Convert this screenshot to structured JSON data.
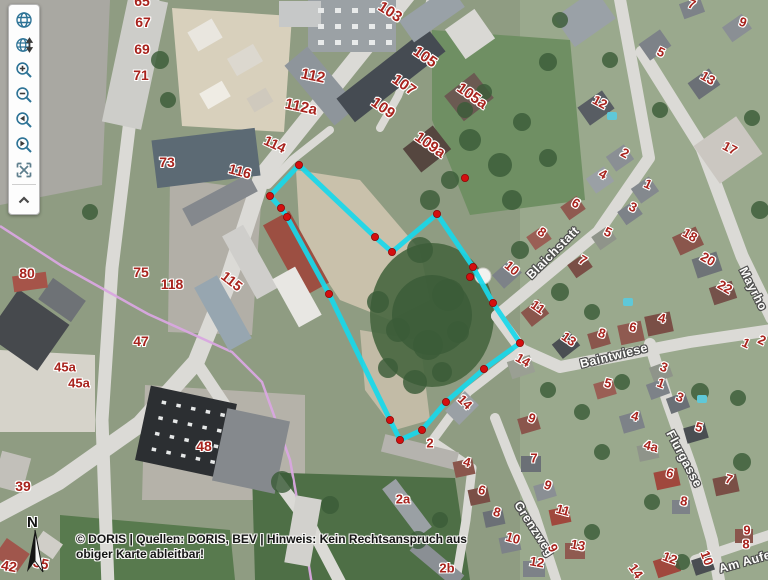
{
  "map": {
    "copyright_line1": "© DORIS | Quellen: DORIS, BEV | Hinweis: Kein Rechtsanspruch aus",
    "copyright_line2": "obiger Karte ableitbar!",
    "north_label": "N",
    "colors": {
      "parcel_stroke": "#18d8ea",
      "vertex_dot": "#d40f0f",
      "house_number": "#a8231d",
      "street_text": "#fdfdfb",
      "boundary_line": "#d9a7e0"
    },
    "house_numbers": [
      {
        "t": "65",
        "x": 142,
        "y": 1,
        "r": 0,
        "s": 14
      },
      {
        "t": "67",
        "x": 143,
        "y": 22,
        "r": 0,
        "s": 14
      },
      {
        "t": "69",
        "x": 142,
        "y": 49,
        "r": 0,
        "s": 14
      },
      {
        "t": "71",
        "x": 141,
        "y": 75,
        "r": 0,
        "s": 14
      },
      {
        "t": "73",
        "x": 167,
        "y": 162,
        "r": 0,
        "s": 14
      },
      {
        "t": "80",
        "x": 27,
        "y": 273,
        "r": 0,
        "s": 14
      },
      {
        "t": "75",
        "x": 141,
        "y": 272,
        "r": 0,
        "s": 14
      },
      {
        "t": "118",
        "x": 172,
        "y": 284,
        "r": 0,
        "s": 14
      },
      {
        "t": "115",
        "x": 232,
        "y": 281,
        "r": 38,
        "s": 14
      },
      {
        "t": "114",
        "x": 275,
        "y": 144,
        "r": 25,
        "s": 14
      },
      {
        "t": "116",
        "x": 240,
        "y": 171,
        "r": 15,
        "s": 14
      },
      {
        "t": "47",
        "x": 141,
        "y": 341,
        "r": 0,
        "s": 14
      },
      {
        "t": "45a",
        "x": 65,
        "y": 367,
        "r": 0,
        "s": 13
      },
      {
        "t": "45a",
        "x": 79,
        "y": 383,
        "r": 0,
        "s": 13
      },
      {
        "t": "39",
        "x": 23,
        "y": 486,
        "r": 0,
        "s": 14
      },
      {
        "t": "48",
        "x": 204,
        "y": 446,
        "r": 0,
        "s": 14
      },
      {
        "t": "42",
        "x": 9,
        "y": 566,
        "r": 10,
        "s": 14
      },
      {
        "t": "35",
        "x": 41,
        "y": 563,
        "r": 12,
        "s": 14
      },
      {
        "t": "112",
        "x": 313,
        "y": 76,
        "r": 12,
        "s": 15
      },
      {
        "t": "112a",
        "x": 301,
        "y": 107,
        "r": 12,
        "s": 15
      },
      {
        "t": "103",
        "x": 390,
        "y": 12,
        "r": 33,
        "s": 15
      },
      {
        "t": "105",
        "x": 425,
        "y": 57,
        "r": 35,
        "s": 15
      },
      {
        "t": "107",
        "x": 404,
        "y": 85,
        "r": 35,
        "s": 15
      },
      {
        "t": "109",
        "x": 383,
        "y": 108,
        "r": 35,
        "s": 15
      },
      {
        "t": "105a",
        "x": 472,
        "y": 96,
        "r": 35,
        "s": 15
      },
      {
        "t": "109a",
        "x": 430,
        "y": 145,
        "r": 35,
        "s": 15
      },
      {
        "t": "7",
        "x": 692,
        "y": 4,
        "r": 20,
        "s": 13
      },
      {
        "t": "9",
        "x": 743,
        "y": 22,
        "r": 20,
        "s": 13
      },
      {
        "t": "5",
        "x": 661,
        "y": 52,
        "r": 25,
        "s": 13
      },
      {
        "t": "13",
        "x": 708,
        "y": 78,
        "r": 30,
        "s": 13
      },
      {
        "t": "12",
        "x": 600,
        "y": 102,
        "r": 28,
        "s": 13
      },
      {
        "t": "17",
        "x": 730,
        "y": 148,
        "r": 28,
        "s": 13
      },
      {
        "t": "2",
        "x": 625,
        "y": 153,
        "r": 28,
        "s": 13
      },
      {
        "t": "4",
        "x": 603,
        "y": 174,
        "r": 28,
        "s": 13
      },
      {
        "t": "1",
        "x": 648,
        "y": 184,
        "r": 25,
        "s": 13
      },
      {
        "t": "6",
        "x": 576,
        "y": 203,
        "r": 30,
        "s": 13
      },
      {
        "t": "3",
        "x": 633,
        "y": 207,
        "r": 25,
        "s": 13
      },
      {
        "t": "8",
        "x": 542,
        "y": 232,
        "r": 35,
        "s": 13
      },
      {
        "t": "5",
        "x": 608,
        "y": 232,
        "r": 25,
        "s": 13
      },
      {
        "t": "7",
        "x": 583,
        "y": 260,
        "r": 30,
        "s": 13
      },
      {
        "t": "18",
        "x": 690,
        "y": 235,
        "r": 30,
        "s": 13
      },
      {
        "t": "20",
        "x": 708,
        "y": 259,
        "r": 30,
        "s": 13
      },
      {
        "t": "22",
        "x": 725,
        "y": 287,
        "r": 30,
        "s": 13
      },
      {
        "t": "10",
        "x": 512,
        "y": 268,
        "r": 40,
        "s": 13
      },
      {
        "t": "11",
        "x": 538,
        "y": 307,
        "r": 35,
        "s": 13
      },
      {
        "t": "1",
        "x": 746,
        "y": 343,
        "r": 25,
        "s": 13
      },
      {
        "t": "2",
        "x": 762,
        "y": 340,
        "r": 25,
        "s": 13
      },
      {
        "t": "13",
        "x": 569,
        "y": 339,
        "r": 35,
        "s": 13
      },
      {
        "t": "14",
        "x": 523,
        "y": 360,
        "r": 30,
        "s": 13
      },
      {
        "t": "8",
        "x": 602,
        "y": 333,
        "r": 16,
        "s": 13
      },
      {
        "t": "6",
        "x": 633,
        "y": 327,
        "r": 12,
        "s": 13
      },
      {
        "t": "4",
        "x": 662,
        "y": 318,
        "r": 12,
        "s": 13
      },
      {
        "t": "3",
        "x": 664,
        "y": 367,
        "r": 20,
        "s": 13
      },
      {
        "t": "1",
        "x": 661,
        "y": 383,
        "r": 20,
        "s": 13
      },
      {
        "t": "3",
        "x": 680,
        "y": 397,
        "r": 20,
        "s": 13
      },
      {
        "t": "5",
        "x": 608,
        "y": 383,
        "r": 15,
        "s": 13
      },
      {
        "t": "14",
        "x": 465,
        "y": 402,
        "r": 45,
        "s": 13
      },
      {
        "t": "9",
        "x": 532,
        "y": 418,
        "r": 20,
        "s": 13
      },
      {
        "t": "4",
        "x": 635,
        "y": 416,
        "r": 15,
        "s": 13
      },
      {
        "t": "5",
        "x": 699,
        "y": 427,
        "r": 15,
        "s": 13
      },
      {
        "t": "7",
        "x": 534,
        "y": 458,
        "r": 0,
        "s": 13
      },
      {
        "t": "7",
        "x": 729,
        "y": 479,
        "r": 15,
        "s": 13
      },
      {
        "t": "4a",
        "x": 651,
        "y": 446,
        "r": 15,
        "s": 13
      },
      {
        "t": "6",
        "x": 670,
        "y": 473,
        "r": 15,
        "s": 13
      },
      {
        "t": "9",
        "x": 548,
        "y": 485,
        "r": 20,
        "s": 13
      },
      {
        "t": "8",
        "x": 684,
        "y": 501,
        "r": 10,
        "s": 13
      },
      {
        "t": "8",
        "x": 497,
        "y": 512,
        "r": 15,
        "s": 13
      },
      {
        "t": "11",
        "x": 563,
        "y": 510,
        "r": 15,
        "s": 13
      },
      {
        "t": "9",
        "x": 747,
        "y": 530,
        "r": 0,
        "s": 13
      },
      {
        "t": "8",
        "x": 746,
        "y": 544,
        "r": 0,
        "s": 13
      },
      {
        "t": "10",
        "x": 513,
        "y": 538,
        "r": 15,
        "s": 13
      },
      {
        "t": "13",
        "x": 578,
        "y": 545,
        "r": 10,
        "s": 13
      },
      {
        "t": "12",
        "x": 537,
        "y": 562,
        "r": 10,
        "s": 13
      },
      {
        "t": "9",
        "x": 553,
        "y": 548,
        "r": 65,
        "s": 13
      },
      {
        "t": "14",
        "x": 636,
        "y": 571,
        "r": 55,
        "s": 13
      },
      {
        "t": "12",
        "x": 670,
        "y": 558,
        "r": 20,
        "s": 13
      },
      {
        "t": "10",
        "x": 707,
        "y": 558,
        "r": 70,
        "s": 13
      },
      {
        "t": "2",
        "x": 430,
        "y": 443,
        "r": 0,
        "s": 13
      },
      {
        "t": "4",
        "x": 467,
        "y": 462,
        "r": 15,
        "s": 13
      },
      {
        "t": "2a",
        "x": 403,
        "y": 499,
        "r": 0,
        "s": 13
      },
      {
        "t": "6",
        "x": 482,
        "y": 490,
        "r": 15,
        "s": 13
      },
      {
        "t": "2b",
        "x": 447,
        "y": 568,
        "r": 0,
        "s": 13
      }
    ],
    "street_names": [
      {
        "t": "Blaichstatt",
        "x": 553,
        "y": 253,
        "r": -45
      },
      {
        "t": "Baintwiese",
        "x": 614,
        "y": 356,
        "r": -14
      },
      {
        "t": "Mayrho",
        "x": 753,
        "y": 289,
        "r": 63
      },
      {
        "t": "Flurgasse",
        "x": 684,
        "y": 459,
        "r": 62
      },
      {
        "t": "Grenzweg",
        "x": 534,
        "y": 529,
        "r": 57
      },
      {
        "t": "Am Aufe",
        "x": 745,
        "y": 562,
        "r": -16
      }
    ],
    "parcel_polygon": [
      [
        299,
        165
      ],
      [
        375,
        237
      ],
      [
        392,
        252
      ],
      [
        437,
        214
      ],
      [
        473,
        267
      ],
      [
        493,
        303
      ],
      [
        520,
        343
      ],
      [
        484,
        369
      ],
      [
        446,
        402
      ],
      [
        422,
        430
      ],
      [
        400,
        440
      ],
      [
        390,
        420
      ],
      [
        329,
        294
      ],
      [
        287,
        217
      ],
      [
        281,
        208
      ],
      [
        270,
        196
      ]
    ],
    "vertex_dots": [
      [
        299,
        165
      ],
      [
        375,
        237
      ],
      [
        392,
        252
      ],
      [
        437,
        214
      ],
      [
        473,
        267
      ],
      [
        470,
        277
      ],
      [
        493,
        303
      ],
      [
        520,
        343
      ],
      [
        484,
        369
      ],
      [
        446,
        402
      ],
      [
        422,
        430
      ],
      [
        400,
        440
      ],
      [
        390,
        420
      ],
      [
        329,
        294
      ],
      [
        287,
        217
      ],
      [
        281,
        208
      ],
      [
        270,
        196
      ]
    ],
    "extra_dots": [
      [
        465,
        178
      ]
    ],
    "boundary_line": [
      [
        0,
        226
      ],
      [
        62,
        266
      ],
      [
        148,
        314
      ],
      [
        232,
        352
      ],
      [
        262,
        382
      ],
      [
        290,
        460
      ],
      [
        308,
        560
      ],
      [
        312,
        585
      ]
    ]
  },
  "toolbar": {
    "icons": [
      {
        "name": "globe-icon"
      },
      {
        "name": "globe-extent-icon"
      },
      {
        "name": "zoom-in-icon"
      },
      {
        "name": "zoom-out-icon"
      },
      {
        "name": "prev-extent-icon"
      },
      {
        "name": "next-extent-icon"
      },
      {
        "name": "pan-icon"
      },
      {
        "name": "collapse-icon"
      }
    ]
  }
}
